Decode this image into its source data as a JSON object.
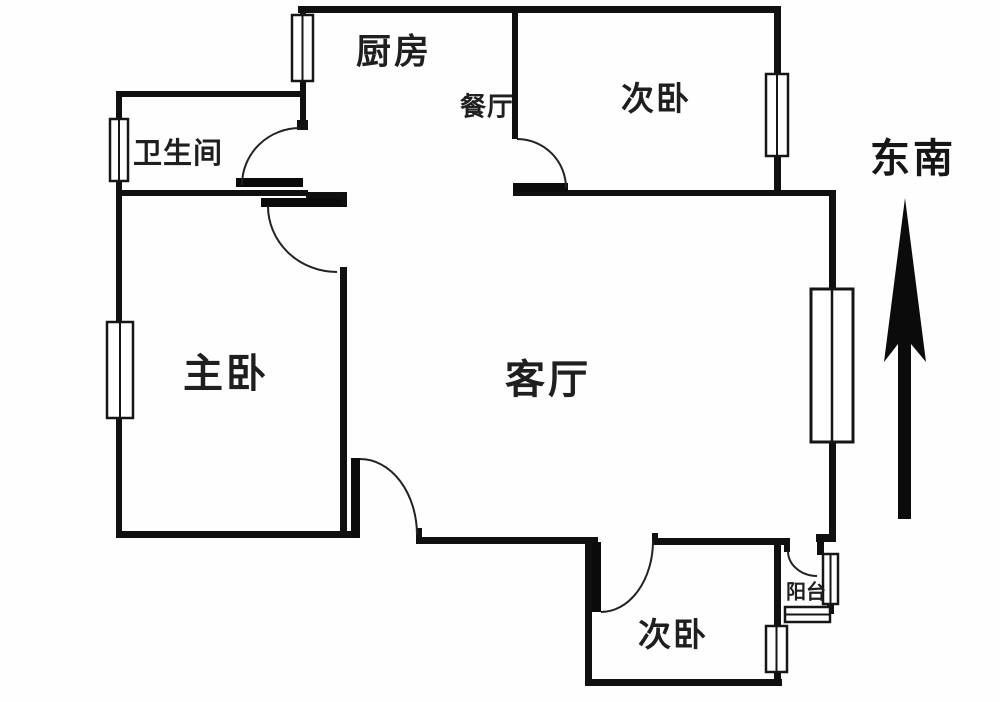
{
  "floorplan": {
    "rooms": [
      {
        "name": "kitchen",
        "label": "厨房"
      },
      {
        "name": "dining-room",
        "label": "餐厅"
      },
      {
        "name": "bedroom-top-right",
        "label": "次卧"
      },
      {
        "name": "bathroom",
        "label": "卫生间"
      },
      {
        "name": "master-bedroom",
        "label": "主卧"
      },
      {
        "name": "living-room",
        "label": "客厅"
      },
      {
        "name": "bedroom-bottom",
        "label": "次卧"
      },
      {
        "name": "balcony",
        "label": "阳台"
      }
    ],
    "compass": {
      "label": "东南"
    },
    "colors": {
      "background": "#ffffff",
      "wall": "#101010",
      "door_arc": "#222222",
      "window_stroke": "#161616",
      "text": "#1f1f1f"
    }
  }
}
